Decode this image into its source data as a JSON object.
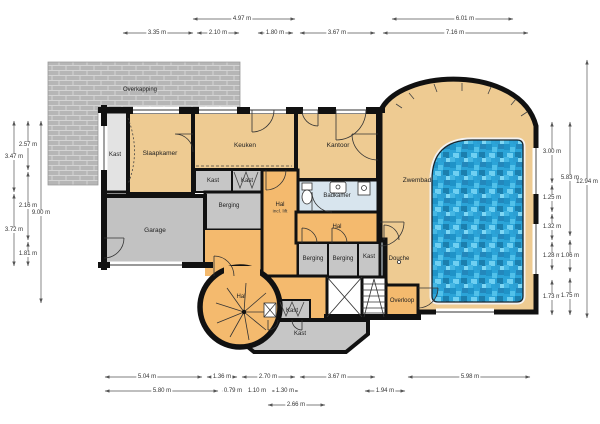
{
  "plan": {
    "type": "floorplan",
    "language": "nl"
  },
  "rooms": {
    "overkapping": "Overkapping",
    "kast": "Kast",
    "slaapkamer": "Slaapkamer",
    "keuken": "Keuken",
    "kantoor": "Kantoor",
    "badkamer": "Badkamer",
    "hal": "Hal",
    "hal_note": "incl. lift",
    "garage": "Garage",
    "berging": "Berging",
    "douche": "Douche",
    "overloop": "Overloop",
    "zwembad": "Zwembad"
  },
  "dimensions": {
    "top_row1": [
      "4.97 m",
      "6.01 m"
    ],
    "top_row2": [
      "3.35 m",
      "2.10 m",
      "1.80 m",
      "3.67 m",
      "7.16 m"
    ],
    "left_outer": [
      "3.47 m",
      "3.72 m"
    ],
    "left_inner": [
      "2.57 m",
      "2.16 m",
      "1.81 m"
    ],
    "left_total": "9.00 m",
    "right_inner": [
      "3.00 m",
      "1.25 m",
      "1.32 m",
      "1.28 m",
      "1.73 m"
    ],
    "right_mid": [
      "5.83 m",
      "1.06 m",
      "1.75 m"
    ],
    "right_total": "12.94 m",
    "bottom_row1": [
      "5.04 m",
      "1.36 m",
      "2.70 m",
      "3.67 m",
      "5.98 m"
    ],
    "bottom_row2": [
      "5.80 m",
      "0.79 m",
      "1.10 m",
      "1.30 m",
      "1.94 m"
    ],
    "bottom_row3": [
      "2.66 m"
    ]
  },
  "colors": {
    "wall": "#111111",
    "floor_tan": "#eecb92",
    "floor_hal": "#f4ba6e",
    "floor_gray": "#c6c6c6",
    "bathroom_blue": "#d8e5ee",
    "pool_water": "#2ba4d8",
    "brick": "#b6b6b6"
  }
}
